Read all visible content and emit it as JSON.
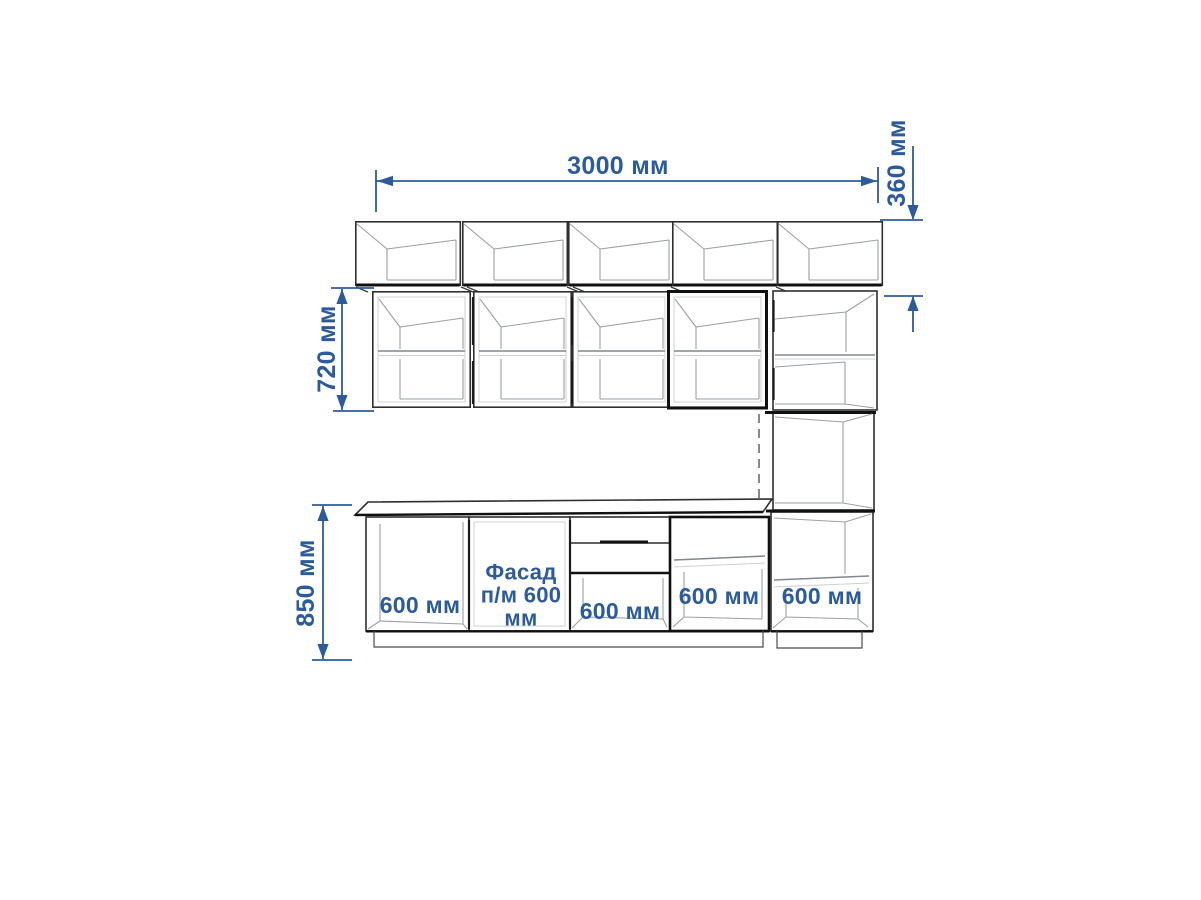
{
  "dimension_labels": {
    "total_width": "3000 мм",
    "top_row_height": "360 мм",
    "wall_row_height": "720 мм",
    "base_row_height": "850 мм"
  },
  "cabinet_labels": {
    "base_1": "600 мм",
    "base_2": "Фасад\nп/м 600\nмм",
    "base_3": "600 мм",
    "base_4": "600 мм",
    "tall_base": "600 мм"
  },
  "colors": {
    "dimension_blue": "#2b5b9c",
    "outline": "#2f2f2f",
    "outline_heavy": "#101010",
    "interior_line": "#9aa0a6",
    "background": "#ffffff"
  }
}
